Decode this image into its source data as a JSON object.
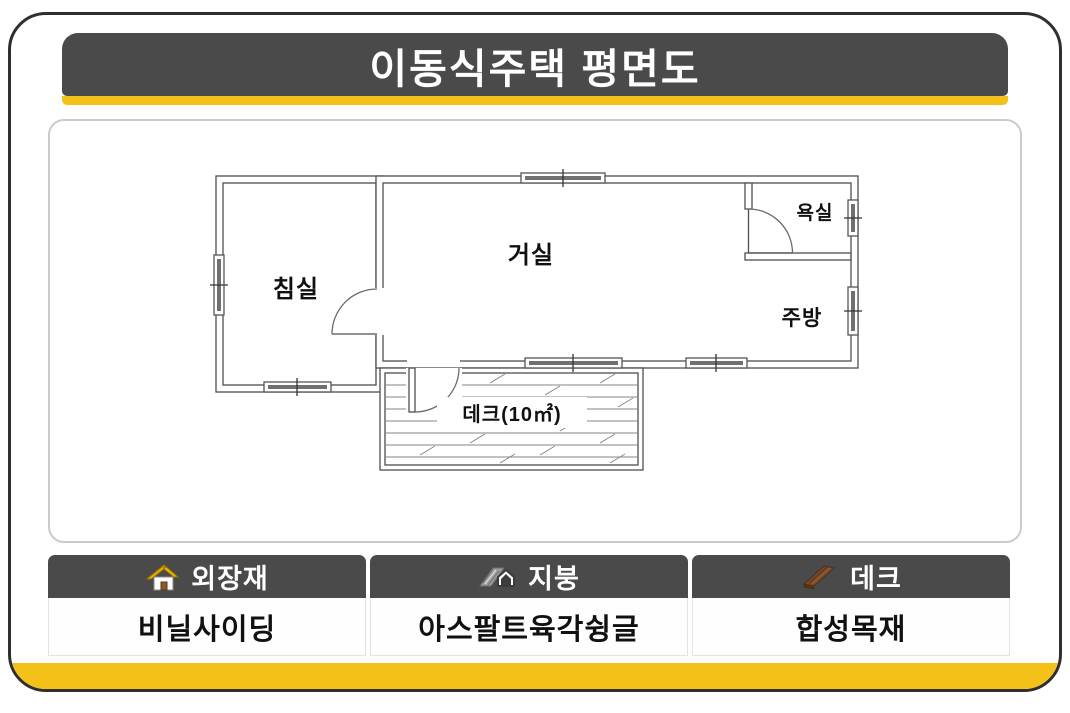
{
  "title": "이동식주택 평면도",
  "colors": {
    "accent_yellow": "#f3c118",
    "header_gray": "#4a4a4a",
    "wall_line": "#4f4f4f"
  },
  "floor_plan": {
    "rooms": {
      "bedroom": "침실",
      "living_room": "거실",
      "bathroom": "욕실",
      "kitchen": "주방",
      "deck": "데크(10㎡)"
    }
  },
  "spec_table": {
    "columns": [
      {
        "icon": "house-icon",
        "header": "외장재",
        "value": "비닐사이딩"
      },
      {
        "icon": "roof-icon",
        "header": "지붕",
        "value": "아스팔트육각슁글"
      },
      {
        "icon": "deck-icon",
        "header": "데크",
        "value": "합성목재"
      }
    ]
  }
}
